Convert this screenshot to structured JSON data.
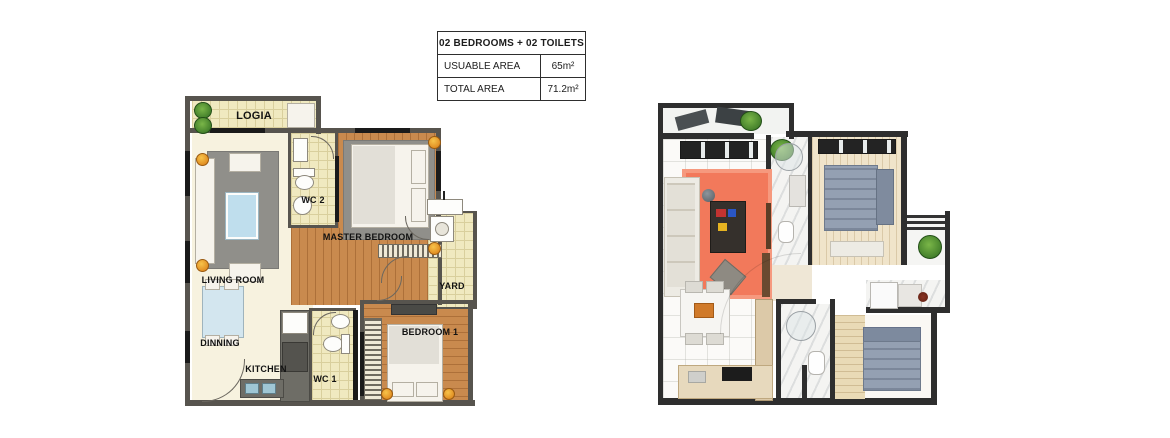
{
  "info_table": {
    "header": "02 BEDROOMS + 02 TOILETS",
    "rows": [
      {
        "label": "USUABLE AREA",
        "value": "65m²"
      },
      {
        "label": "TOTAL AREA",
        "value": "71.2m²"
      }
    ]
  },
  "plan_2d": {
    "labels": {
      "logia": "LOGIA",
      "living_room": "LIVING ROOM",
      "wc2": "WC 2",
      "master_bedroom": "MASTER BEDROOM",
      "yard": "YARD",
      "dinning": "DINNING",
      "kitchen": "KITCHEN",
      "wc1": "WC 1",
      "bedroom1": "BEDROOM 1"
    }
  },
  "colors": {
    "wall_gray": "#57544e",
    "wall_black": "#1a1a1a",
    "wall_3d": "#2e2e2e",
    "tile_yellow": "#f0e9c0",
    "floor_cream": "#f7f2df",
    "floor_wood": "#c98a4e",
    "rug_gray": "#908f8a",
    "rug_orange": "#f2795b",
    "bed_gray_blue": "#94a0b2",
    "accent_lamp_orange": "#d97a14",
    "coffee_table_blue": "#bfdeed",
    "kitchen_counter": "#6e6d66",
    "plant_green": "#2f6b20"
  }
}
